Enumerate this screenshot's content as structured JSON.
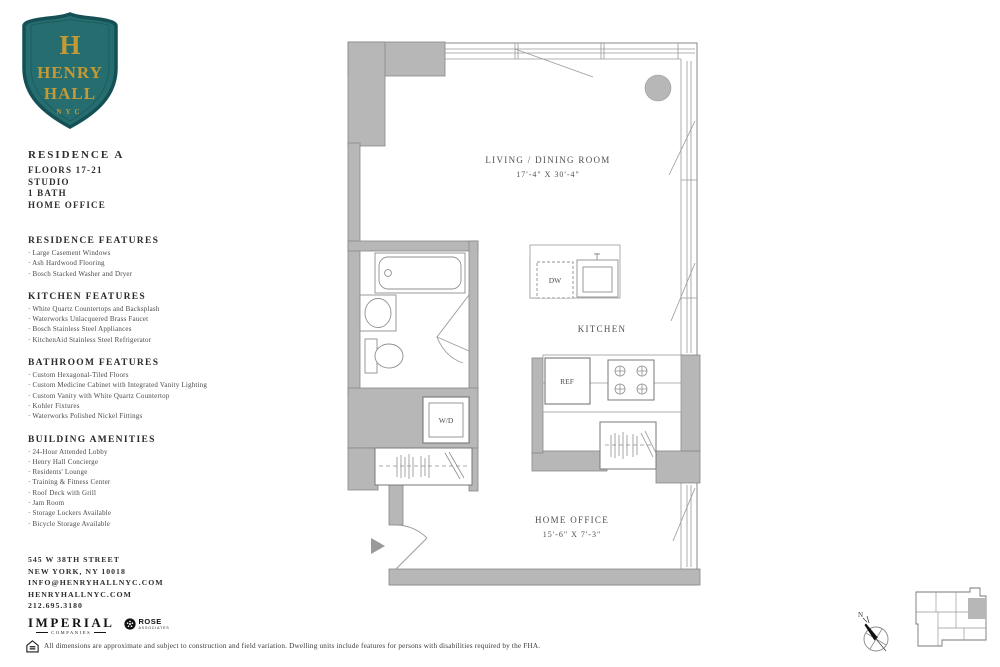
{
  "logo": {
    "initial": "H",
    "name_line1": "HENRY",
    "name_line2": "HALL",
    "city": "NYC"
  },
  "residence": {
    "title": "RESIDENCE A",
    "lines": [
      "FLOORS 17-21",
      "STUDIO",
      "1 BATH",
      "HOME OFFICE"
    ]
  },
  "sections": [
    {
      "heading": "RESIDENCE FEATURES",
      "items": [
        "Large Casement Windows",
        "Ash Hardwood Flooring",
        "Bosch Stacked Washer and Dryer"
      ]
    },
    {
      "heading": "KITCHEN FEATURES",
      "items": [
        "White Quartz Countertops and Backsplash",
        "Waterworks Unlacquered Brass Faucet",
        "Bosch Stainless Steel Appliances",
        "KitchenAid Stainless Steel Refrigerator"
      ]
    },
    {
      "heading": "BATHROOM FEATURES",
      "items": [
        "Custom Hexagonal-Tiled Floors",
        "Custom Medicine Cabinet with Integrated Vanity Lighting",
        "Custom Vanity with White Quartz Countertop",
        "Kohler Fixtures",
        "Waterworks Polished Nickel Fittings"
      ]
    },
    {
      "heading": "BUILDING AMENITIES",
      "items": [
        "24-Hour Attended Lobby",
        "Henry Hall Concierge",
        "Residents' Lounge",
        "Training & Fitness Center",
        "Roof Deck with Grill",
        "Jam Room",
        "Storage Lockers Available",
        "Bicycle Storage Available"
      ]
    }
  ],
  "contact": {
    "address_line1": "545 W 38TH STREET",
    "address_line2": "NEW YORK, NY 10018",
    "email": "INFO@HENRYHALLNYC.COM",
    "website": "HENRYHALLNYC.COM",
    "phone": "212.695.3180"
  },
  "partners": {
    "imperial_name": "IMPERIAL",
    "imperial_sub": "COMPANIES",
    "rose_name": "ROSE",
    "rose_sub": "ASSOCIATES"
  },
  "disclaimer": "All dimensions are approximate and subject to construction and field variation. Dwelling units include features for persons with disabilities required by the FHA.",
  "floorplan": {
    "living_room": {
      "label": "LIVING / DINING ROOM",
      "dims": "17'-4\" X 30'-4\""
    },
    "kitchen": {
      "label": "KITCHEN"
    },
    "home_office": {
      "label": "HOME OFFICE",
      "dims": "15'-6\" X 7'-3\""
    },
    "appliances": {
      "washer_dryer": "W/D",
      "dishwasher": "DW",
      "refrigerator": "REF"
    }
  },
  "compass": {
    "north_label": "N"
  },
  "colors": {
    "shield_teal": "#266d70",
    "shield_border": "#145055",
    "shield_gold": "#c49a34",
    "wall_gray": "#b7b7b7",
    "line_gray": "#9a9a9a",
    "text_dark": "#2e2e2e"
  }
}
